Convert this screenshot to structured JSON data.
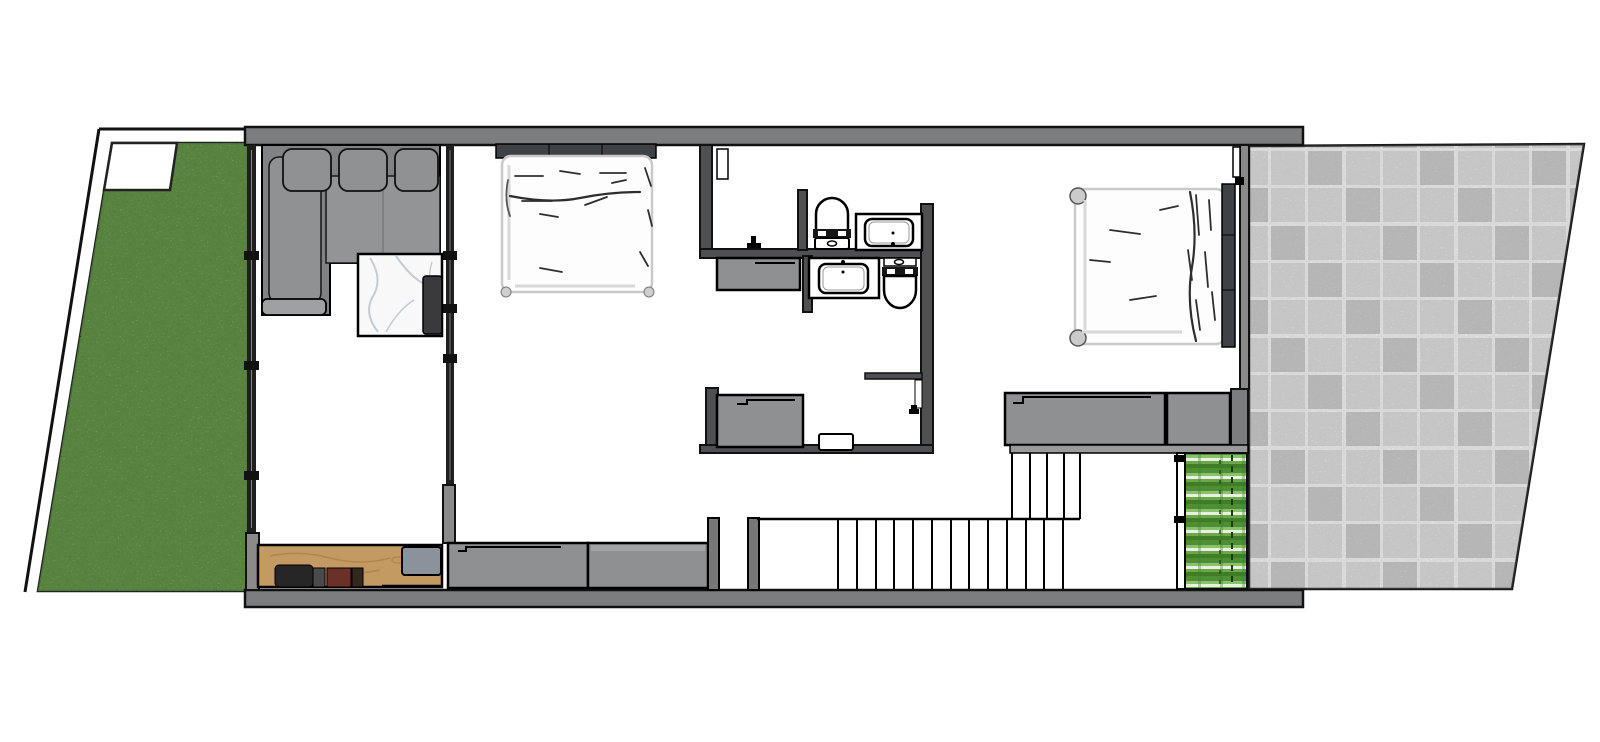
{
  "meta": {
    "title": "upper-floor-plan-top-view",
    "canvas": {
      "width": 1600,
      "height": 742
    },
    "text_labels_visible": "none"
  },
  "palette": {
    "outline": "#111111",
    "wall_gray": "#7b7d7e",
    "wall_dark": "#4e5052",
    "window_wall": "#1f1f1f",
    "jamb_gray": "#8a8a8a",
    "cabinet_gray": "#8f9092",
    "cabinet_light": "#a2a3a5",
    "sofa_base": "#808284",
    "sofa_cushion": "#8f9193",
    "sofa_seat": "#939496",
    "headboard": "#3e4246",
    "bed_white": "#fdfdfd",
    "bed_stroke": "#c9c9c9",
    "wrinkle": "#2e2e2e",
    "lawn_green": "#6f9f53",
    "lawn_dark": "#567f3e",
    "planter_green": "#4f8f33",
    "planter_light": "#8abf6d",
    "wood": "#c49a63",
    "wood_dark": "#a87e49",
    "marble_vein": "#c6cbd1",
    "tv_dark": "#3a3a3c",
    "tile_light": "#d6d6d6",
    "tile_mid": "#c2c2c2",
    "tile_grout": "#efefef",
    "desk_gray": "#8a939c",
    "chair_black": "#262626",
    "chair_red": "#6b3028",
    "chair_brown": "#33281e",
    "fixture_white": "#ffffff"
  },
  "scene": {
    "type": "architectural floor plan, top-down 3D render, no text labels",
    "outdoor_left": {
      "name": "lawn-garden",
      "boundary": "slanted property line",
      "corner_pad": "white corner pad at top-left of lawn"
    },
    "outdoor_right": {
      "name": "stone-tile-patio",
      "tiles": "square gray pavers",
      "planter": "green planter strip beside stair hall glass wall"
    },
    "rooms": [
      {
        "name": "living-room",
        "furniture": [
          "l-shaped-sectional-sofa",
          "marble-coffee-table",
          "wall-tv-panel",
          "wood-sideboard",
          "sideboard-equipment",
          "gray-desktop-unit"
        ]
      },
      {
        "name": "bedroom-1",
        "furniture": [
          "double-bed",
          "dark-headboard",
          "built-in-wardrobe-1",
          "built-in-wardrobe-2"
        ]
      },
      {
        "name": "bathroom",
        "fixtures": [
          "walk-in-shower",
          "shower-mixer",
          "toilet-north",
          "vanity-sink-north",
          "vanity-sink-south",
          "toilet-south",
          "gray-low-cabinet",
          "bath-door-leaf"
        ]
      },
      {
        "name": "inner-closet-room",
        "fixtures": [
          "gray-cabinet",
          "door-threshold",
          "door-leaf-with-handle"
        ]
      },
      {
        "name": "bedroom-2",
        "furniture": [
          "double-bed",
          "dark-headboard",
          "bed-corner-posts",
          "wardrobe-1",
          "wardrobe-2",
          "patio-door-leaf"
        ]
      },
      {
        "name": "stair-hall",
        "features": [
          "u-shaped-staircase",
          "landing",
          "glass-wall-to-planter",
          "entry-door-recess"
        ]
      }
    ],
    "stairs": {
      "lower_run_tread_lines": 13,
      "upper_run_tread_lines": 5,
      "landing_position": "bottom-right"
    }
  }
}
